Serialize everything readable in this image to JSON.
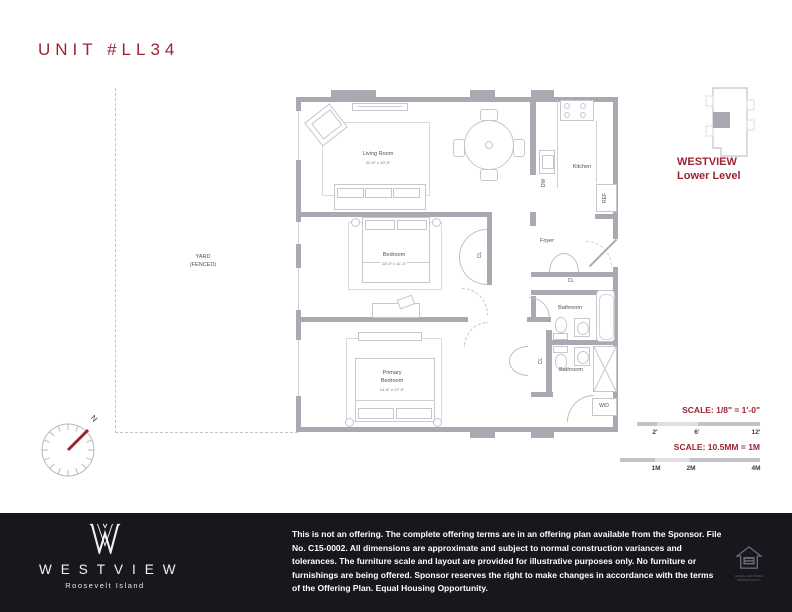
{
  "page": {
    "title": "UNIT #LL34"
  },
  "plan": {
    "living_room": {
      "label": "Living Room",
      "dims": "21'-6\" x 13'-3\""
    },
    "kitchen": {
      "label": "Kitchen"
    },
    "bedroom": {
      "label": "Bedroom",
      "dims": "14'-0\" x 11'-4\""
    },
    "primary_bedroom": {
      "label1": "Primary",
      "label2": "Bedroom",
      "dims": "14'-6\" x 17'-0\""
    },
    "foyer": {
      "label": "Foyer"
    },
    "bathroom_upper": {
      "label": "Bathroom"
    },
    "bathroom_lower": {
      "label": "Bathroom"
    },
    "closet": "CL",
    "washer_dryer": "W/D",
    "dishwasher": "DW",
    "refrigerator": "REF",
    "yard_line1": "YARD",
    "yard_line2": "(FENCED)",
    "north": "N"
  },
  "keyplan": {
    "name": "WESTVIEW",
    "level": "Lower Level"
  },
  "scale_imperial": {
    "label": "SCALE: 1/8\" = 1'-0\"",
    "tick1": "2'",
    "tick2": "6'",
    "tick3": "12'"
  },
  "scale_metric": {
    "label": "SCALE: 10.5MM = 1M",
    "tick1": "1M",
    "tick2": "2M",
    "tick3": "4M"
  },
  "footer": {
    "brand": "WESTVIEW",
    "location": "Roosevelt Island",
    "disclaimer": "This is not an offering. The complete offering terms are in an offering plan available from the Sponsor. File No. C15-0002. All dimensions are approximate and subject to normal construction variances and tolerances. The furniture scale and layout are provided for illustrative purposes only. No furniture or furnishings are being offered. Sponsor reserves the right to make changes in accordance with the terms of the Offering Plan. Equal Housing Opportunity.",
    "eho": "EQUAL HOUSING OPPORTUNITY"
  },
  "colors": {
    "accent": "#9e2231",
    "wall": "#a9a9b1",
    "footer_bg": "#17171e"
  }
}
